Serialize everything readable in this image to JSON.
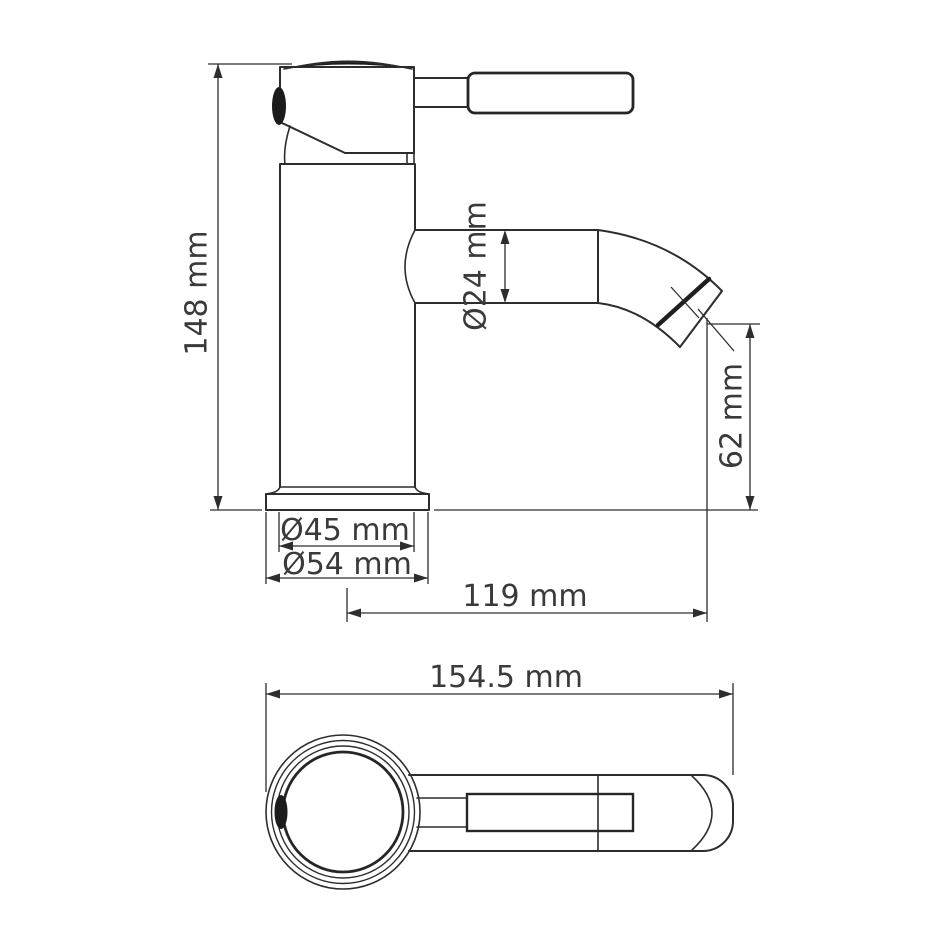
{
  "drawing": {
    "background_color": "#ffffff",
    "line_color": "#2d2d2d",
    "text_color": "#3a3a3a",
    "side_view": {
      "labels": {
        "height": "148 mm",
        "spout_diameter": "Ø24 mm",
        "outlet_height": "62 mm",
        "spout_reach": "119 mm",
        "body_diameter": "Ø45 mm",
        "base_diameter": "Ø54 mm"
      }
    },
    "top_view": {
      "labels": {
        "overall_length": "154.5 mm"
      }
    }
  }
}
